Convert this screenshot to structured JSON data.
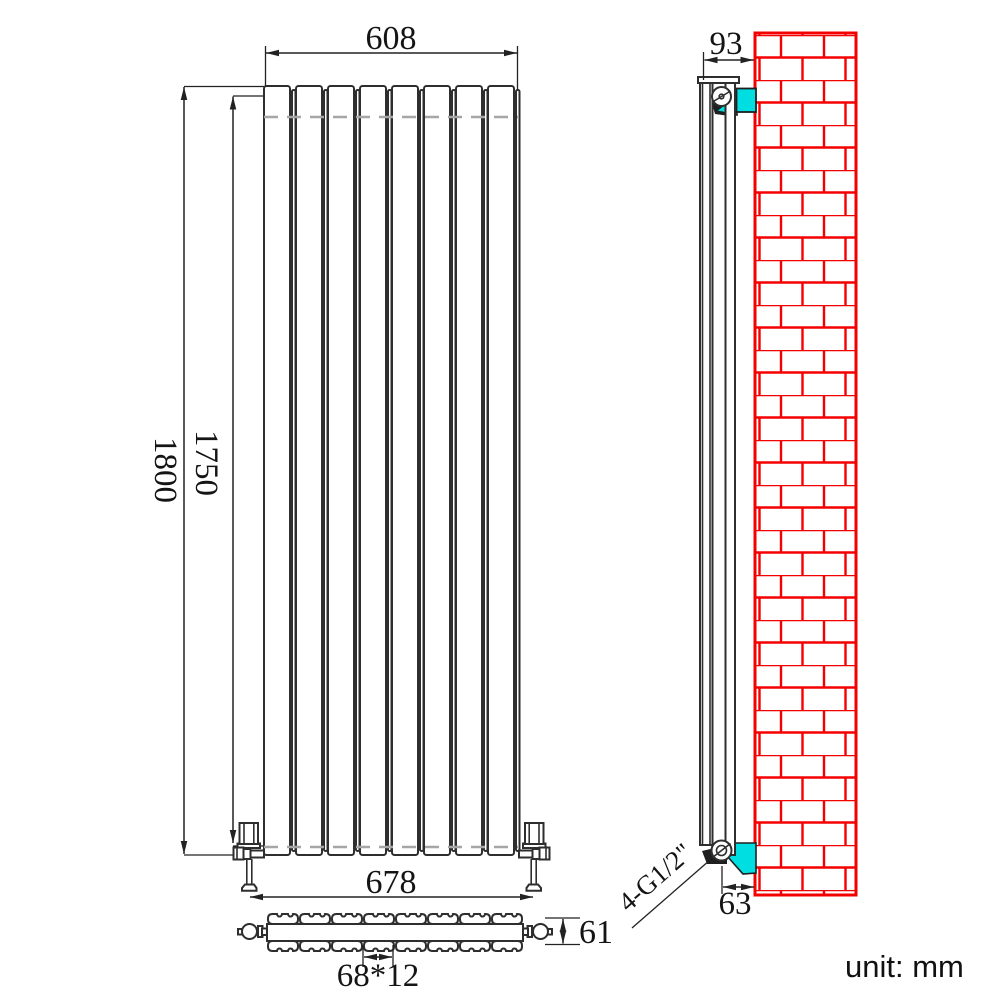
{
  "drawing": {
    "type": "vertical panel radiator technical drawing",
    "views": {
      "front": {
        "panel_count": 8,
        "dim_width_top": "608",
        "dim_height_total": "1800",
        "dim_height_panel": "1750",
        "dim_valve_span": "678"
      },
      "plan": {
        "panel_count": 8,
        "dim_depth": "61",
        "dim_panel_pitch": "68*12"
      },
      "side": {
        "dim_depth_with_bracket": "93",
        "dim_bracket_offset": "63",
        "connection_label": "4-G1/2\""
      }
    },
    "footer": {
      "unit_label": "unit: mm"
    }
  },
  "colors": {
    "line": "#2e2e2e",
    "hidden": "#a6a6a6",
    "brick_red": "#f50000",
    "bracket_cyan": "#00dee2",
    "text": "#141414",
    "background": "#ffffff"
  }
}
